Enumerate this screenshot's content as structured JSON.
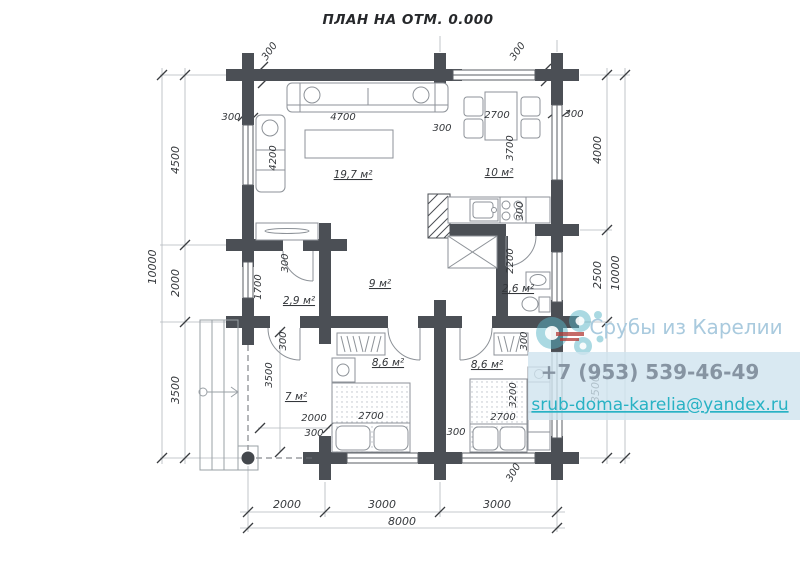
{
  "title": "ПЛАН НА ОТМ. 0.000",
  "watermark": {
    "company": "Срубы из Карелии",
    "phone": "+7 (953) 539-46-49",
    "email": "srub-doma-karelia@yandex.ru"
  },
  "rooms": {
    "living": "19,7 м²",
    "kitchen": "10 м²",
    "hall": "9 м²",
    "storage": "2,9 м²",
    "bathroom": "2,6 м²",
    "entry": "7 м²",
    "bedroom1": "8,6 м²",
    "bedroom2": "8,6 м²"
  },
  "dims": {
    "left": [
      "4500",
      "2000",
      "3500"
    ],
    "left_total": "10000",
    "right": [
      "4000",
      "2500",
      "3500"
    ],
    "right_total": "10000",
    "bottom": [
      "2000",
      "3000",
      "3000"
    ],
    "bottom_total": "8000",
    "wall": "300",
    "sofa_length": "4700",
    "corner_sofa_length": "4200",
    "dining_width": "2700",
    "kitchen_depth": "3700",
    "storage_width": "1700",
    "bathroom_depth": "2200",
    "entry_depth": "3500",
    "entry_width": "2000",
    "bed1_width": "2700",
    "bed2_width": "2700",
    "bed2_length": "3200"
  }
}
